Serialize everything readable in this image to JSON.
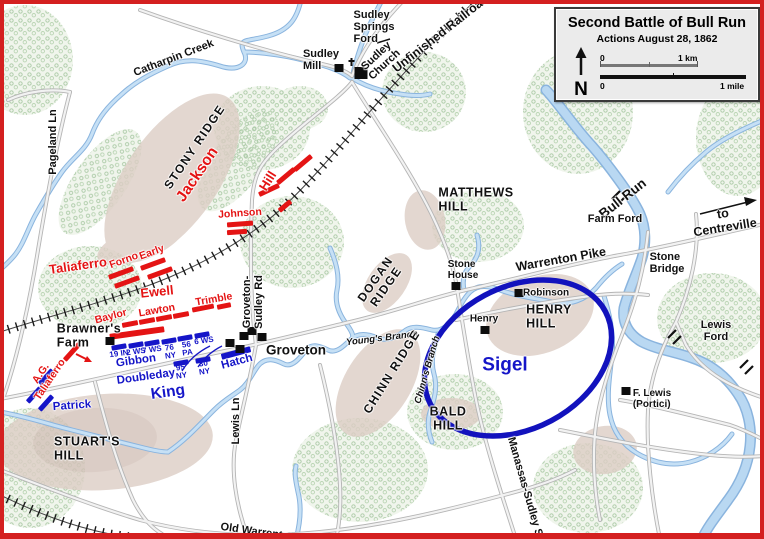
{
  "window": {
    "type": "battle-map"
  },
  "colors": {
    "frame_red": "#d42020",
    "confederate_red": "#e41414",
    "union_blue": "#1515c8",
    "water": "#bcd9f2",
    "water_edge": "#8ab4de",
    "terrain_tan": "#dccdc5",
    "tree_green": "#a9c9a4",
    "road_gray": "#b5b5b5"
  },
  "legend": {
    "title": "Second Battle of Bull Run",
    "subtitle": "Actions August 28, 1862",
    "compass": "N",
    "scale": {
      "km_zero": "0",
      "km_label": "1 km",
      "mile_zero": "0",
      "mile_label": "1 mile"
    }
  },
  "labels": [
    {
      "n": "sudley-springs-ford",
      "t": "Sudley\nSprings\nFord",
      "x": 374,
      "y": 28,
      "c": "k",
      "a": "l"
    },
    {
      "n": "sudley-mill",
      "t": "Sudley\nMill",
      "x": 321,
      "y": 61,
      "c": "k",
      "a": "l"
    },
    {
      "n": "sudley-church",
      "t": "Sudley\nChurch",
      "x": 381,
      "y": 61,
      "r": -43,
      "c": "k"
    },
    {
      "n": "unfinished-railroad",
      "t": "Unfinished Railroad",
      "x": 441,
      "y": 34,
      "r": -38,
      "c": "roadbig"
    },
    {
      "n": "catharpin-creek",
      "t": "Catharpin  Creek",
      "x": 174,
      "y": 59,
      "r": -21,
      "c": "k"
    },
    {
      "n": "pageland-ln",
      "t": "Pageland Ln",
      "x": 54,
      "y": 142,
      "r": -90,
      "c": "road"
    },
    {
      "n": "stony-ridge",
      "t": "STONY RIDGE",
      "x": 195,
      "y": 147,
      "r": -56,
      "c": "ridge"
    },
    {
      "n": "jackson",
      "t": "Jackson",
      "x": 198,
      "y": 175,
      "r": -56,
      "c": "red1"
    },
    {
      "n": "hill",
      "t": "Hill",
      "x": 268,
      "y": 181,
      "r": -58,
      "c": "red2"
    },
    {
      "n": "johnson",
      "t": "Johnson",
      "x": 240,
      "y": 214,
      "r": -4,
      "c": "red3"
    },
    {
      "n": "taliaferro",
      "t": "Taliaferro",
      "x": 78,
      "y": 266,
      "r": -8,
      "c": "red2"
    },
    {
      "n": "forno",
      "t": "Forno",
      "x": 124,
      "y": 261,
      "r": -20,
      "c": "red3"
    },
    {
      "n": "early",
      "t": "Early",
      "x": 152,
      "y": 253,
      "r": -20,
      "c": "red3"
    },
    {
      "n": "ewell",
      "t": "Ewell",
      "x": 157,
      "y": 292,
      "r": -6,
      "c": "red2"
    },
    {
      "n": "baylor",
      "t": "Baylor",
      "x": 111,
      "y": 317,
      "r": -15,
      "c": "red3"
    },
    {
      "n": "lawton",
      "t": "Lawton",
      "x": 157,
      "y": 311,
      "r": -10,
      "c": "red3"
    },
    {
      "n": "trimble",
      "t": "Trimble",
      "x": 214,
      "y": 300,
      "r": -10,
      "c": "red3"
    },
    {
      "n": "ag-taliaferro",
      "t": "A.G.\nTaliaferro",
      "x": 46,
      "y": 377,
      "r": -56,
      "c": "red3"
    },
    {
      "n": "brawners-farm",
      "t": "Brawner's\nFarm",
      "x": 89,
      "y": 336,
      "c": "hill",
      "a": "l"
    },
    {
      "n": "gibbon",
      "t": "Gibbon",
      "x": 136,
      "y": 361,
      "r": -8,
      "c": "blue3"
    },
    {
      "n": "regt-19in",
      "t": "19 IN",
      "x": 119,
      "y": 354,
      "r": -8,
      "c": "blue4"
    },
    {
      "n": "regt-2ws",
      "t": "2 WS",
      "x": 136,
      "y": 352,
      "r": -8,
      "c": "blue4"
    },
    {
      "n": "regt-7ws",
      "t": "7 WS",
      "x": 152,
      "y": 350,
      "r": -8,
      "c": "blue4"
    },
    {
      "n": "regt-76ny",
      "t": "76\nNY",
      "x": 170,
      "y": 352,
      "r": -8,
      "c": "blue4"
    },
    {
      "n": "regt-56pa",
      "t": "56\nPA",
      "x": 187,
      "y": 349,
      "r": -8,
      "c": "blue4"
    },
    {
      "n": "regt-6ws",
      "t": "6 WS",
      "x": 204,
      "y": 341,
      "r": -8,
      "c": "blue4"
    },
    {
      "n": "doubleday",
      "t": "Doubleday",
      "x": 146,
      "y": 377,
      "r": -8,
      "c": "blue3"
    },
    {
      "n": "regt-95ny",
      "t": "95\nNY",
      "x": 181,
      "y": 372,
      "r": -8,
      "c": "blue4"
    },
    {
      "n": "regt-30ny",
      "t": "30\nNY",
      "x": 204,
      "y": 368,
      "r": -8,
      "c": "blue4"
    },
    {
      "n": "king",
      "t": "King",
      "x": 168,
      "y": 393,
      "r": -8,
      "c": "blue2"
    },
    {
      "n": "hatch",
      "t": "Hatch",
      "x": 237,
      "y": 362,
      "r": -15,
      "c": "blue3"
    },
    {
      "n": "patrick",
      "t": "Patrick",
      "x": 72,
      "y": 406,
      "r": -4,
      "c": "blue3"
    },
    {
      "n": "stuarts-hill",
      "t": "STUART'S\nHILL",
      "x": 87,
      "y": 449,
      "c": "hill",
      "a": "l"
    },
    {
      "n": "lewis-ln",
      "t": "Lewis Ln",
      "x": 237,
      "y": 421,
      "r": -90,
      "c": "road"
    },
    {
      "n": "groveton-sudley-rd",
      "t": "Groveton-\nSudley Rd",
      "x": 254,
      "y": 302,
      "r": -90,
      "c": "road"
    },
    {
      "n": "groveton",
      "t": "Groveton",
      "x": 296,
      "y": 351,
      "c": "town"
    },
    {
      "n": "dogan-ridge",
      "t": "DOGAN\nRIDGE",
      "x": 381,
      "y": 283,
      "r": -55,
      "c": "ridge"
    },
    {
      "n": "youngs-branch",
      "t": "Young's Branch",
      "x": 382,
      "y": 339,
      "r": -7,
      "c": "stream"
    },
    {
      "n": "chinn-ridge",
      "t": "CHINN RIDGE",
      "x": 392,
      "y": 372,
      "r": -58,
      "c": "ridge"
    },
    {
      "n": "chinns-branch",
      "t": "Chinn's Branch",
      "x": 428,
      "y": 370,
      "r": -74,
      "c": "stream"
    },
    {
      "n": "bald-hill",
      "t": "BALD\nHILL",
      "x": 448,
      "y": 419,
      "c": "hill"
    },
    {
      "n": "matthews-hill",
      "t": "MATTHEWS\nHILL",
      "x": 476,
      "y": 200,
      "c": "hill",
      "a": "l"
    },
    {
      "n": "stone-house",
      "t": "Stone\nHouse",
      "x": 463,
      "y": 271,
      "c": "ksm",
      "a": "l"
    },
    {
      "n": "warrenton-pike",
      "t": "Warrenton Pike",
      "x": 561,
      "y": 260,
      "r": -10,
      "c": "roadbig"
    },
    {
      "n": "robinson",
      "t": "Robinson",
      "x": 546,
      "y": 294,
      "c": "ksm"
    },
    {
      "n": "henry",
      "t": "Henry",
      "x": 484,
      "y": 320,
      "c": "ksm"
    },
    {
      "n": "henry-hill",
      "t": "HENRY\nHILL",
      "x": 549,
      "y": 317,
      "c": "hill",
      "a": "l"
    },
    {
      "n": "sigel",
      "t": "Sigel",
      "x": 505,
      "y": 366,
      "c": "blue1"
    },
    {
      "n": "bull-run",
      "t": "Bull Run",
      "x": 623,
      "y": 199,
      "r": -38,
      "c": "town"
    },
    {
      "n": "farm-ford",
      "t": "Farm Ford",
      "x": 615,
      "y": 220,
      "c": "k"
    },
    {
      "n": "to-centreville",
      "t": "to Centreville",
      "x": 724,
      "y": 221,
      "r": -9,
      "c": "roadbig"
    },
    {
      "n": "stone-bridge",
      "t": "Stone\nBridge",
      "x": 667,
      "y": 264,
      "c": "k",
      "a": "l"
    },
    {
      "n": "lewis-ford",
      "t": "Lewis Ford",
      "x": 716,
      "y": 332,
      "c": "k"
    },
    {
      "n": "f-lewis-portici",
      "t": "F. Lewis\n(Portici)",
      "x": 652,
      "y": 400,
      "c": "ksm",
      "a": "l"
    },
    {
      "n": "manassas-sudley-rd",
      "t": "Manassas-Sudley S",
      "x": 524,
      "y": 487,
      "r": 74,
      "c": "road"
    },
    {
      "n": "old-warrenton-rd",
      "t": "Old Warrenton",
      "x": 258,
      "y": 533,
      "r": 8,
      "c": "road"
    }
  ],
  "confederate_bars": [
    {
      "x": 269,
      "y": 190,
      "r": -25,
      "w": 22
    },
    {
      "x": 286,
      "y": 176,
      "r": -40,
      "w": 22
    },
    {
      "x": 303,
      "y": 163,
      "r": -40,
      "w": 22
    },
    {
      "x": 285,
      "y": 206,
      "r": -40,
      "w": 15
    },
    {
      "x": 240,
      "y": 224,
      "r": -4,
      "w": 26
    },
    {
      "x": 237,
      "y": 232,
      "r": -4,
      "w": 20
    },
    {
      "x": 121,
      "y": 273,
      "r": -20,
      "w": 26
    },
    {
      "x": 127,
      "y": 282,
      "r": -20,
      "w": 26
    },
    {
      "x": 153,
      "y": 264,
      "r": -20,
      "w": 26
    },
    {
      "x": 160,
      "y": 273,
      "r": -20,
      "w": 26
    },
    {
      "x": 130,
      "y": 324,
      "r": -11,
      "w": 16
    },
    {
      "x": 147,
      "y": 321,
      "r": -11,
      "w": 16
    },
    {
      "x": 164,
      "y": 318,
      "r": -11,
      "w": 16
    },
    {
      "x": 181,
      "y": 315,
      "r": -11,
      "w": 16
    },
    {
      "x": 203,
      "y": 308,
      "r": -11,
      "w": 22
    },
    {
      "x": 224,
      "y": 306,
      "r": -11,
      "w": 14
    },
    {
      "x": 137,
      "y": 333,
      "r": -8,
      "w": 55,
      "h": 6
    },
    {
      "x": 72,
      "y": 352,
      "r": -48,
      "w": 22
    }
  ],
  "union_bars": [
    {
      "x": 119,
      "y": 347,
      "r": -10,
      "w": 15
    },
    {
      "x": 136,
      "y": 345,
      "r": -10,
      "w": 15
    },
    {
      "x": 152,
      "y": 343,
      "r": -10,
      "w": 15
    },
    {
      "x": 169,
      "y": 341,
      "r": -10,
      "w": 15
    },
    {
      "x": 185,
      "y": 338,
      "r": -10,
      "w": 15
    },
    {
      "x": 202,
      "y": 335,
      "r": -10,
      "w": 15
    },
    {
      "x": 236,
      "y": 353,
      "r": -15,
      "w": 30,
      "h": 6
    },
    {
      "x": 181,
      "y": 363,
      "r": -10,
      "w": 15
    },
    {
      "x": 203,
      "y": 360,
      "r": -10,
      "w": 15
    },
    {
      "x": 46,
      "y": 377,
      "r": -48,
      "w": 19
    },
    {
      "x": 34,
      "y": 395,
      "r": -48,
      "w": 19
    },
    {
      "x": 46,
      "y": 403,
      "r": -48,
      "w": 19
    }
  ],
  "buildings": [
    {
      "n": "sudley-mill-building",
      "x": 339,
      "y": 68
    },
    {
      "n": "sudley-church-building",
      "x": 361,
      "y": 73,
      "church": true
    },
    {
      "n": "brawner-farm-building",
      "x": 110,
      "y": 341
    },
    {
      "n": "groveton-building",
      "x": 230,
      "y": 343
    },
    {
      "n": "groveton-building",
      "x": 240,
      "y": 349
    },
    {
      "n": "groveton-building",
      "x": 244,
      "y": 336
    },
    {
      "n": "groveton-building",
      "x": 252,
      "y": 331
    },
    {
      "n": "groveton-building",
      "x": 262,
      "y": 337
    },
    {
      "n": "stone-house-building",
      "x": 456,
      "y": 286
    },
    {
      "n": "robinson-house-building",
      "x": 519,
      "y": 293
    },
    {
      "n": "henry-house-building",
      "x": 485,
      "y": 330
    },
    {
      "n": "f-lewis-building",
      "x": 626,
      "y": 391
    }
  ]
}
